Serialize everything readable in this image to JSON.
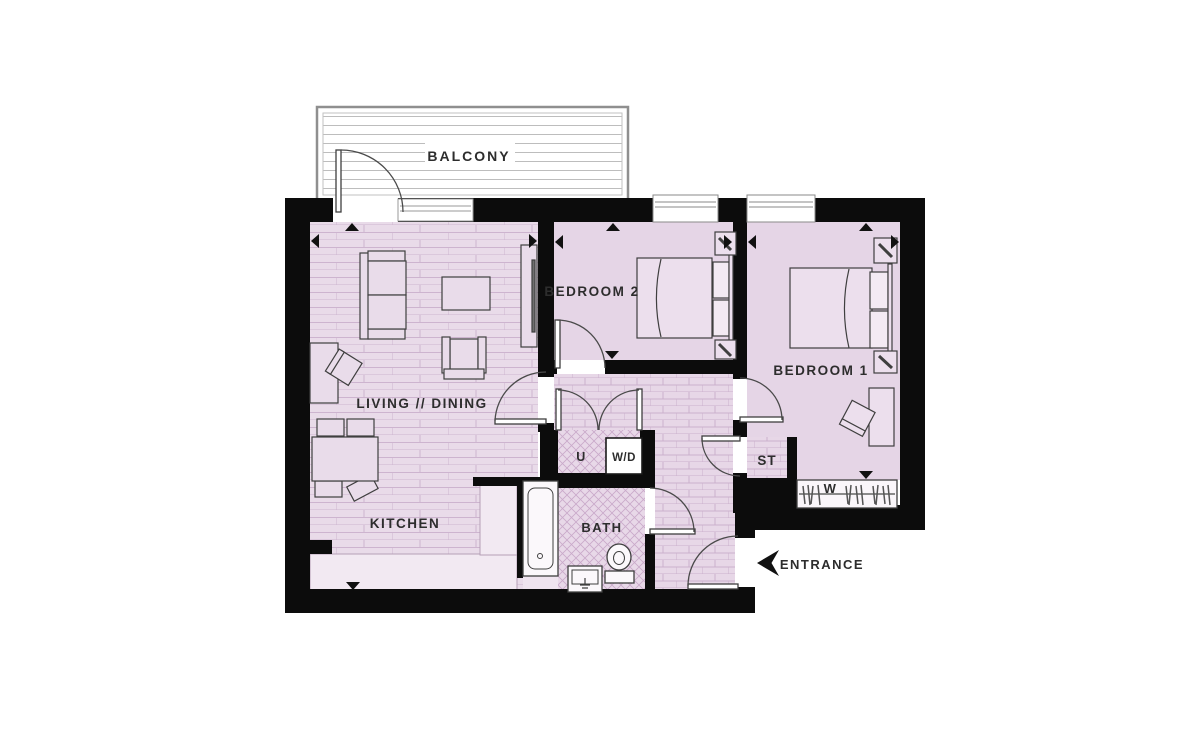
{
  "floorplan": {
    "labels": {
      "balcony": "BALCONY",
      "living_dining": "LIVING // DINING",
      "kitchen": "KITCHEN",
      "bedroom2": "BEDROOM 2",
      "bedroom1": "BEDROOM 1",
      "bath": "BATH",
      "utility": "U",
      "washer_dryer": "W/D",
      "store": "ST",
      "wardrobe": "W",
      "entrance": "ENTRANCE"
    },
    "colors": {
      "wall": "#0c0c0c",
      "floor_plain": "#e5d5e6",
      "floor_plank_base": "#e9dbe9",
      "floor_plank_line": "#cdb4cf",
      "tile_line": "#c9a9ca",
      "hall_brick_line": "#cbb0cc",
      "counter": "#f2e9f2",
      "label_text": "#2d2d2d",
      "balcony_line": "#bdbdbd",
      "furniture_outline": "#3f3f3f"
    }
  }
}
